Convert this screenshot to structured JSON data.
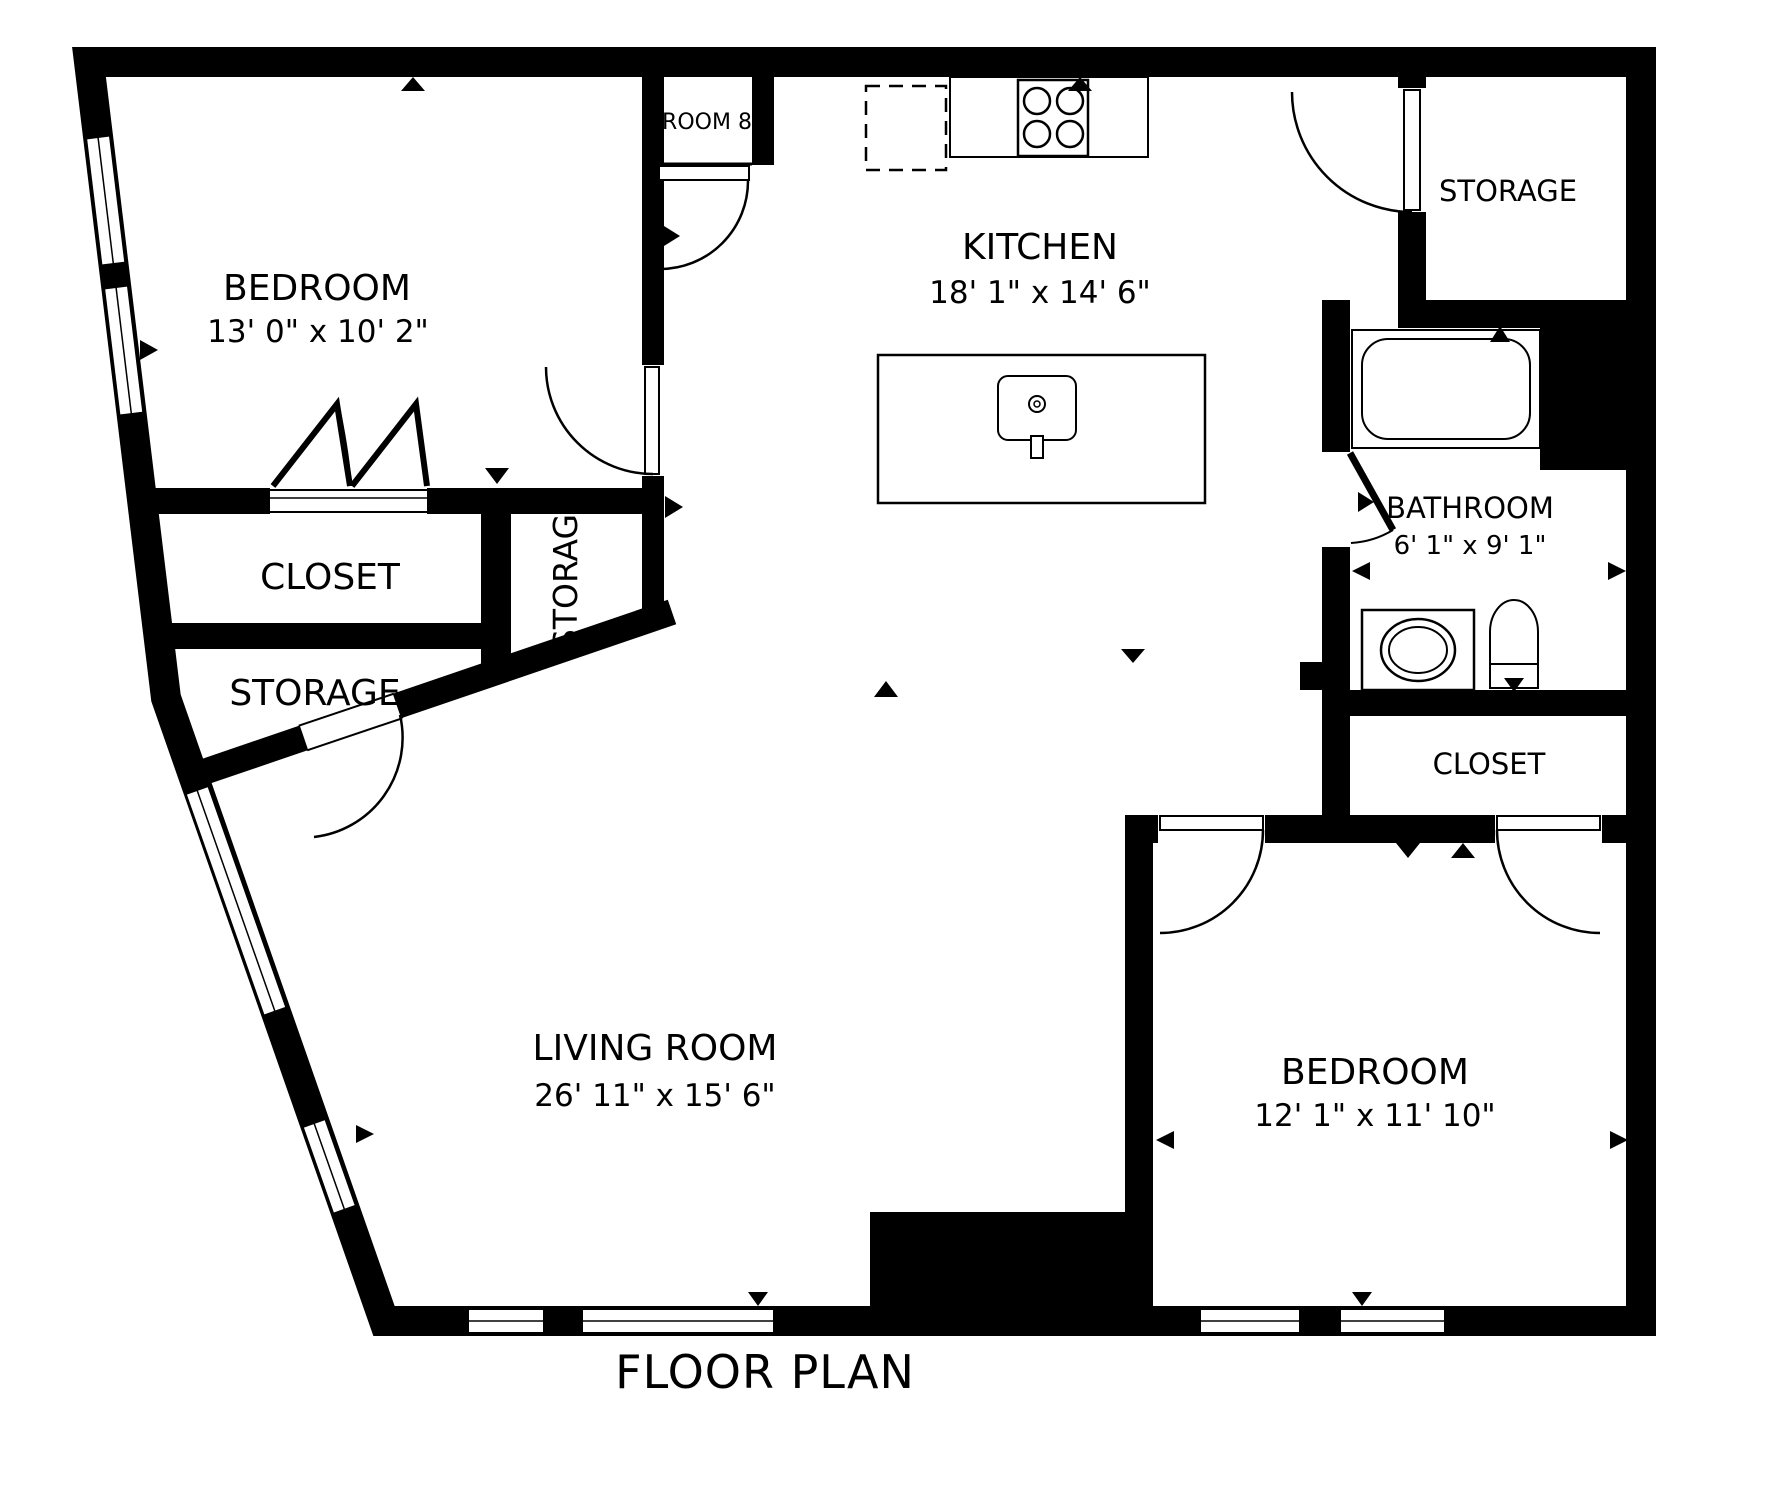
{
  "title": "FLOOR PLAN",
  "colors": {
    "wall": "#000000",
    "floor": "#ffffff",
    "line": "#000000"
  },
  "rooms": {
    "bedroom_tl": {
      "name": "BEDROOM",
      "dims": "13' 0\" x 10' 2\""
    },
    "room8": {
      "name": "ROOM 8"
    },
    "kitchen": {
      "name": "KITCHEN",
      "dims": "18' 1\" x 14' 6\""
    },
    "storage_tr": {
      "name": "STORAGE"
    },
    "bathroom": {
      "name": "BATHROOM",
      "dims": "6' 1\" x 9' 1\""
    },
    "closet_r": {
      "name": "CLOSET"
    },
    "closet_l": {
      "name": "CLOSET"
    },
    "storage_l": {
      "name": "STORAGE"
    },
    "storage_mid": {
      "name": "STORAG"
    },
    "living": {
      "name": "LIVING ROOM",
      "dims": "26' 11\" x 15' 6\""
    },
    "bedroom_br": {
      "name": "BEDROOM",
      "dims": "12' 1\" x 11' 10\""
    }
  },
  "fixtures": {
    "stove": "stove-4-burner",
    "refrigerator": "refrigerator-dashed-outline",
    "island_sink": "kitchen-island-sink",
    "bathtub": "bathtub",
    "vanity": "vanity-sink",
    "toilet": "toilet"
  }
}
